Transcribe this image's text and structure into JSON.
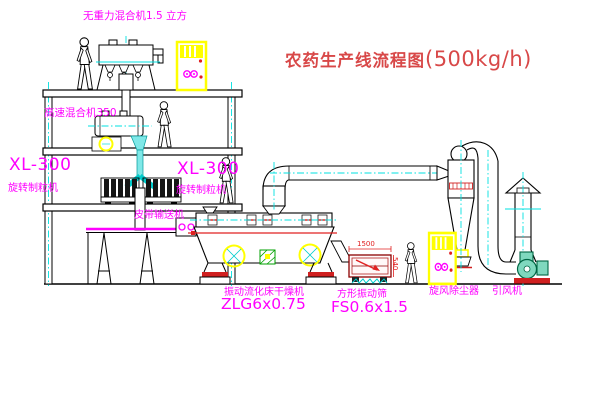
{
  "title": {
    "name": "农药生产线流程图",
    "capacity": "(500kg/h)"
  },
  "equipment": {
    "gravity_mixer": {
      "label": "无重力混合机1.5 立方"
    },
    "high_speed_mixer": {
      "label": "高速混合机350"
    },
    "granulator_left": {
      "model": "XL-300",
      "name": "旋转制粒机"
    },
    "granulator_right": {
      "model": "XL-300",
      "name": "旋转制粒机"
    },
    "belt_conveyor": {
      "label": "皮带输送机"
    },
    "fluid_bed_dryer": {
      "name": "振动流化床干燥机",
      "model": "ZLG6x0.75"
    },
    "vibrating_screen": {
      "name": "方形振动筛",
      "model": "FS0.6x1.5",
      "dim_length": "1500",
      "dim_height": "540"
    },
    "cyclone": {
      "name": "旋风除尘器"
    },
    "induced_draft_fan": {
      "name": "引风机"
    }
  },
  "colors": {
    "label_magenta": "#ff00ff",
    "title_red": "#d84848",
    "centerline_cyan": "#00e0e0",
    "cabinet_yellow": "#ffff00",
    "alert_red": "#e02020"
  }
}
